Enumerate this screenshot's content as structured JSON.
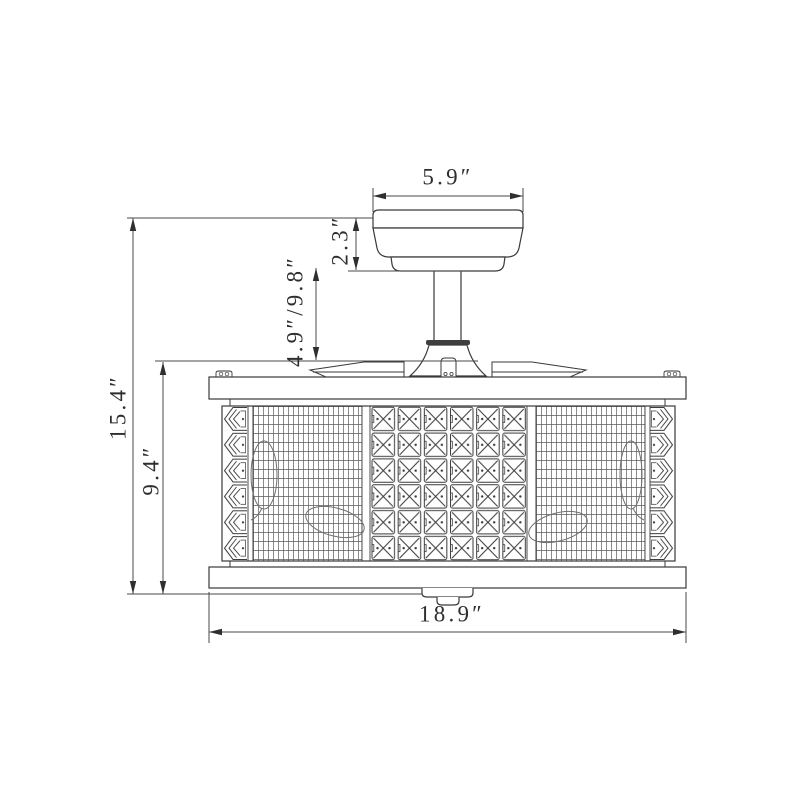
{
  "drawing": {
    "type": "technical-dimension-diagram",
    "subject": "ceiling fan with retractable blades and crystal drum shade",
    "unit": "inches",
    "background": "#ffffff",
    "outline_color": "#3a3a3a",
    "dimension_line_color": "#4a4a4a",
    "text_color": "#2e2e2e",
    "dimensions": {
      "canopy_width": "5.9″",
      "canopy_height": "2.3″",
      "downrod_length": "4.9″/9.8″",
      "overall_height": "15.4″",
      "shade_height": "9.4″",
      "shade_width": "18.9″"
    }
  }
}
